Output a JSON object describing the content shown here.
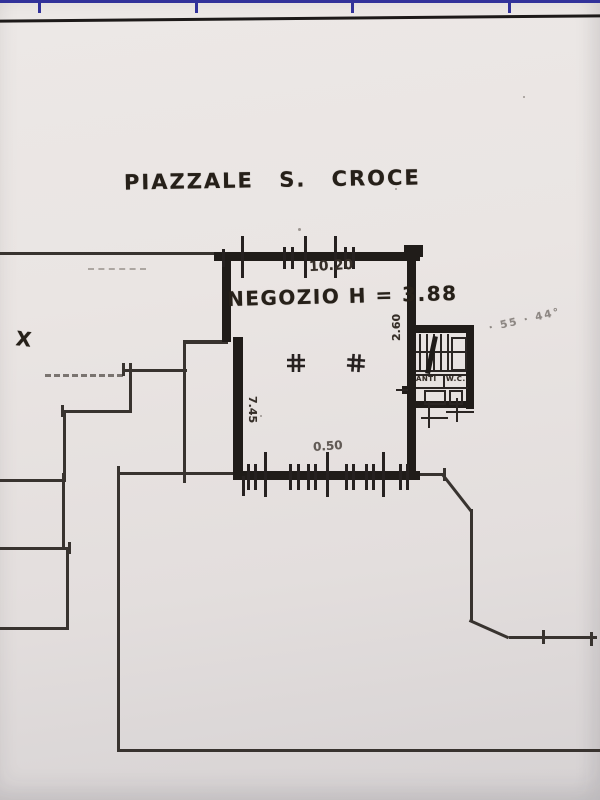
{
  "colors": {
    "paper": "#e9e4e2",
    "ink": "#201c19",
    "frame_blue": "#32329a"
  },
  "header": {
    "street_label": "PIAZZALE S. CROCE"
  },
  "room": {
    "label": "NEGOZIO H = 3.88"
  },
  "dimensions": {
    "top_width": "10.20",
    "left_depth": "7.45",
    "right_recess": "2.60",
    "bottom_small": "0.50"
  },
  "stair_block": {
    "anti_label": "ANTI",
    "wc_label": "W.C."
  },
  "annotations": {
    "x_mark": "X",
    "faint_note": "· 55 · 44°"
  },
  "icons": {
    "column_marker": "#"
  }
}
